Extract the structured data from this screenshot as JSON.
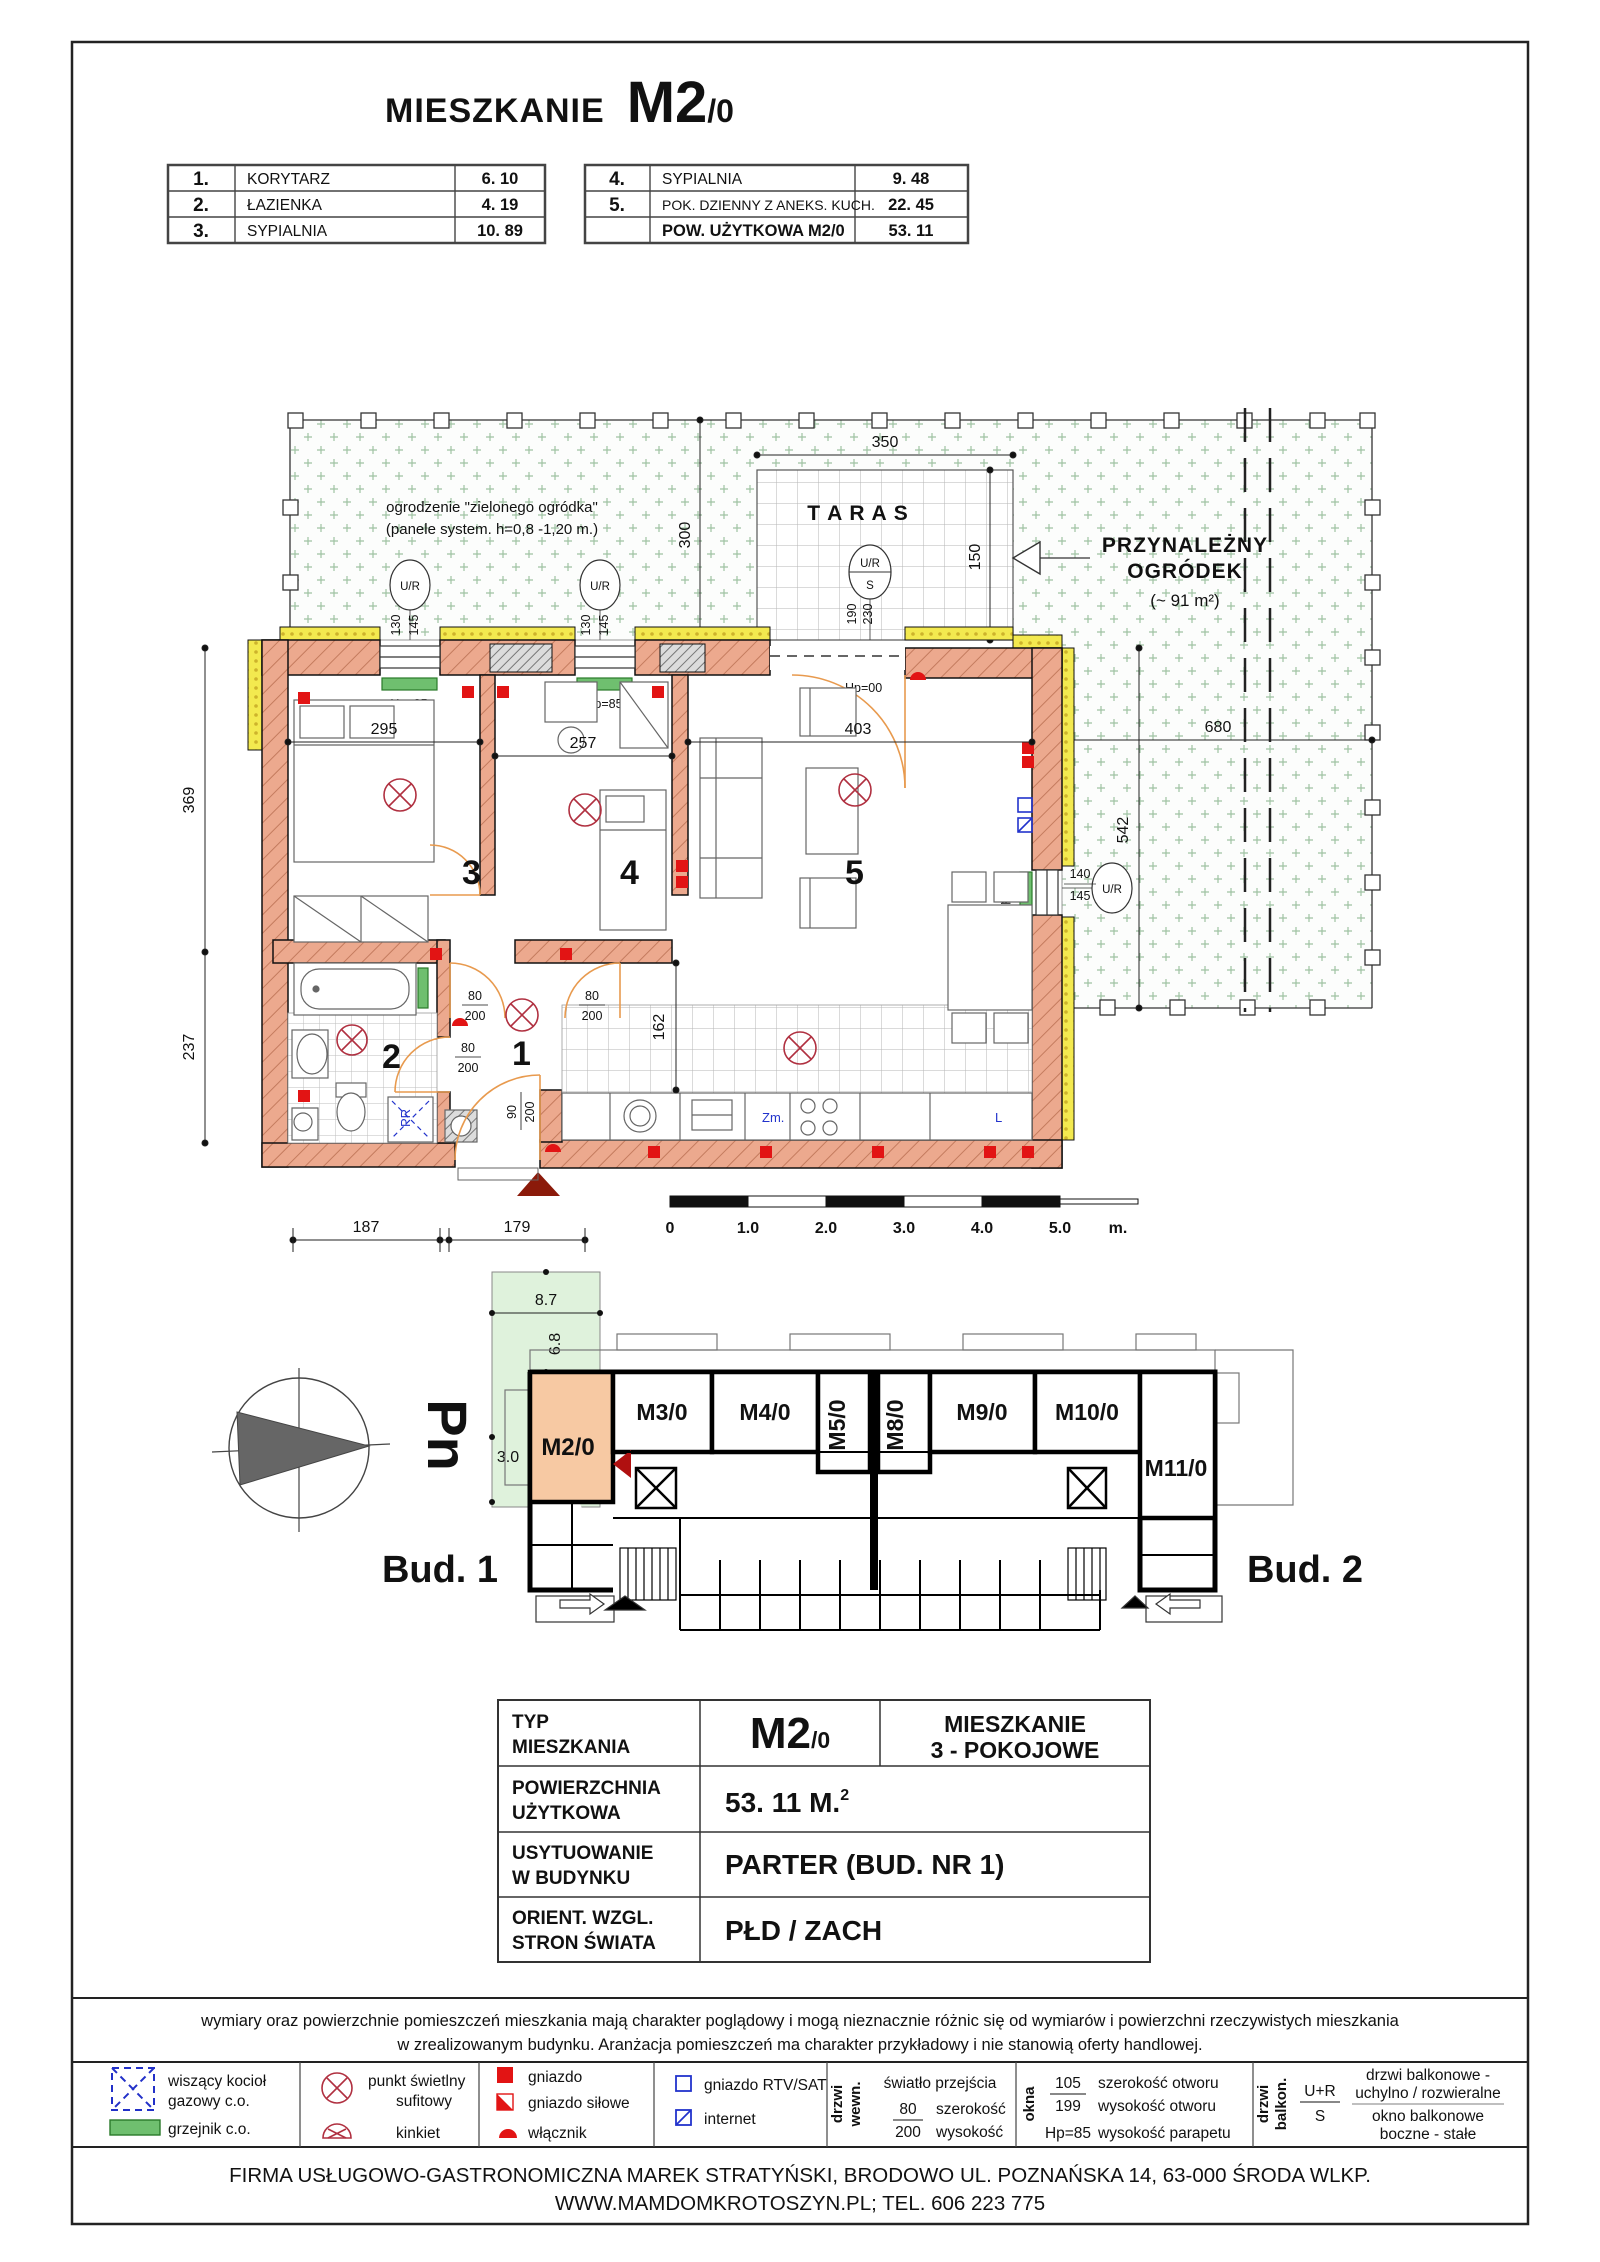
{
  "title": {
    "main": "MIESZKANIE",
    "code": "M2",
    "floor": "/0"
  },
  "summary_left": {
    "rows": [
      {
        "no": "1.",
        "name": "KORYTARZ",
        "area": "6. 10"
      },
      {
        "no": "2.",
        "name": "ŁAZIENKA",
        "area": "4. 19"
      },
      {
        "no": "3.",
        "name": "SYPIALNIA",
        "area": "10. 89"
      }
    ]
  },
  "summary_right": {
    "rows": [
      {
        "no": "4.",
        "name": "SYPIALNIA",
        "area": "9. 48"
      },
      {
        "no": "5.",
        "name": "POK. DZIENNY Z  ANEKS. KUCH.",
        "area": "22. 45"
      }
    ],
    "total_name": "POW. UŻYTKOWA   M2/0",
    "total_area": "53. 11"
  },
  "plan": {
    "fence_note1": "ogrodzenie \"zielonego ogródka\"",
    "fence_note2": "(panele system. h=0,8 -1,20 m.)",
    "taras": "T A R A S",
    "garden1": "PRZYNALEŻNY",
    "garden2": "OGRÓDEK",
    "garden_area": "(~ 91 m²)",
    "ur": "U/R",
    "s": "S",
    "room1": "1",
    "room2": "2",
    "room3": "3",
    "room4": "4",
    "room5": "5",
    "d350": "350",
    "d300": "300",
    "d150": "150",
    "d680": "680",
    "d542": "542",
    "d295": "295",
    "d257": "257",
    "d403": "403",
    "d369": "369",
    "d237": "237",
    "d162": "162",
    "d187": "187",
    "d179": "179",
    "d130": "130",
    "d145": "145",
    "d190": "190",
    "d230": "230",
    "d140": "140",
    "hp85": "Hp=85",
    "hp00": "Hp=00",
    "w80": "80",
    "w90": "90",
    "w200": "200",
    "zm": "Zm.",
    "l": "L",
    "pr": "PR",
    "scale": {
      "s0": "0",
      "s1": "1.0",
      "s2": "2.0",
      "s3": "3.0",
      "s4": "4.0",
      "s5": "5.0",
      "unit": "m."
    }
  },
  "site": {
    "d87": "8.7",
    "d68": "6.8",
    "d30": "3.0",
    "pn": "Pn",
    "bud1": "Bud. 1",
    "bud2": "Bud. 2",
    "m2": "M2/0",
    "m3": "M3/0",
    "m4": "M4/0",
    "m5": "M5/0",
    "m8": "M8/0",
    "m9": "M9/0",
    "m10": "M10/0",
    "m11": "M11/0"
  },
  "info": {
    "r1_label1": "TYP",
    "r1_label2": "MIESZKANIA",
    "r1_value": "M2",
    "r1_value_sub": "/0",
    "r1_extra1": "MIESZKANIE",
    "r1_extra2": "3 - POKOJOWE",
    "r2_label1": "POWIERZCHNIA",
    "r2_label2": "UŻYTKOWA",
    "r2_value": "53. 11  M.",
    "r2_sup": "2",
    "r3_label1": "USYTUOWANIE",
    "r3_label2": "W BUDYNKU",
    "r3_value": "PARTER   (BUD. NR 1)",
    "r4_label1": "ORIENT. WZGL.",
    "r4_label2": "STRON ŚWIATA",
    "r4_value": "PŁD / ZACH"
  },
  "disclaimer": {
    "line1": "wymiary oraz powierzchnie pomieszczeń mieszkania  mają charakter  poglądowy i  mogą nieznacznie różnic się  od wymiarów i powierzchni  rzeczywistych mieszkania",
    "line2": "w zrealizowanym  budynku.  Aranżacja pomieszczeń ma charakter przykładowy i nie stanowią oferty handlowej."
  },
  "legend": {
    "boiler1": "wiszący kocioł",
    "boiler2": "gazowy c.o.",
    "radiator": "grzejnik c.o.",
    "light1": "punkt świetlny",
    "light2": "sufitowy",
    "sconce": "kinkiet",
    "socket": "gniazdo",
    "power": "gniazdo siłowe",
    "switch": "włącznik",
    "rtv": "gniazdo RTV/SAT",
    "internet": "internet",
    "door_int1": "drzwi",
    "door_int2": "wewn.",
    "pass": "światło przejścia",
    "p80": "80",
    "p200": "200",
    "pw": "szerokość",
    "ph": "wysokość",
    "windows": "okna",
    "n105": "105",
    "n199": "199",
    "wo": "szerokość otworu",
    "ho": "wysokość otworu",
    "hp85": "Hp=85",
    "sill": "wysokość parapetu",
    "door_balk1": "drzwi",
    "door_balk2": "balkon.",
    "ur": "U+R",
    "s": "S",
    "b1": "drzwi balkonowe -",
    "b2": "uchylno / rozwieralne",
    "b3": "okno balkonowe",
    "b4": "boczne - stałe"
  },
  "footer": {
    "line1": "FIRMA USŁUGOWO-GASTRONOMICZNA MAREK STRATYŃSKI, BRODOWO UL. POZNAŃSKA 14, 63-000 ŚRODA WLKP.",
    "line2": "WWW.MAMDOMKROTOSZYN.PL; TEL. 606 223 775"
  }
}
